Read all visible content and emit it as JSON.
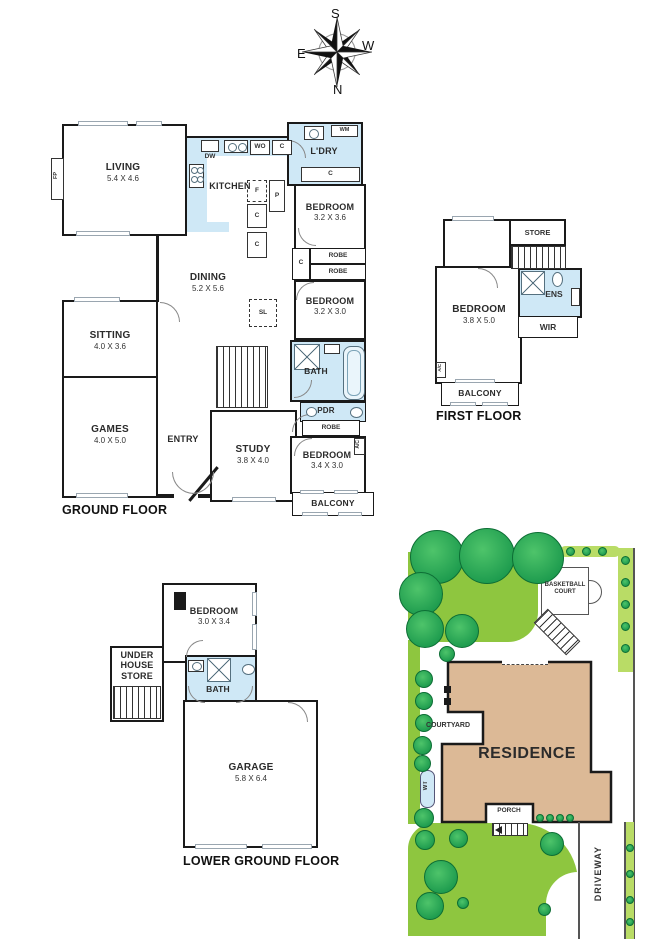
{
  "compass": {
    "top": "S",
    "right": "W",
    "left": "E",
    "bottom": "N"
  },
  "ground_floor": {
    "title": "GROUND FLOOR",
    "living": {
      "name": "LIVING",
      "dims": "5.4 X 4.6"
    },
    "kitchen": {
      "name": "KITCHEN"
    },
    "laundry": {
      "name": "L'DRY"
    },
    "dining": {
      "name": "DINING",
      "dims": "5.2 X 5.6"
    },
    "sitting": {
      "name": "SITTING",
      "dims": "4.0 X 3.6"
    },
    "games": {
      "name": "GAMES",
      "dims": "4.0 X 5.0"
    },
    "entry": {
      "name": "ENTRY"
    },
    "study": {
      "name": "STUDY",
      "dims": "3.8 X 4.0"
    },
    "bedroom1": {
      "name": "BEDROOM",
      "dims": "3.2 X 3.6"
    },
    "bedroom2": {
      "name": "BEDROOM",
      "dims": "3.2 X 3.0"
    },
    "bedroom3": {
      "name": "BEDROOM",
      "dims": "3.4 X 3.0"
    },
    "bath": {
      "name": "BATH"
    },
    "pdr": {
      "name": "PDR"
    },
    "balcony": {
      "name": "BALCONY"
    }
  },
  "first_floor": {
    "title": "FIRST FLOOR",
    "store": {
      "name": "STORE"
    },
    "bedroom": {
      "name": "BEDROOM",
      "dims": "3.8 X 5.0"
    },
    "ens": {
      "name": "ENS"
    },
    "wir": {
      "name": "WIR"
    },
    "balcony": {
      "name": "BALCONY"
    }
  },
  "lower_ground_floor": {
    "title": "LOWER GROUND FLOOR",
    "bedroom": {
      "name": "BEDROOM",
      "dims": "3.0 X 3.4"
    },
    "under_house_store": {
      "name": "UNDER HOUSE STORE"
    },
    "bath": {
      "name": "BATH"
    },
    "garage": {
      "name": "GARAGE",
      "dims": "5.8 X 6.4"
    }
  },
  "site_plan": {
    "residence": "RESIDENCE",
    "courtyard": "COURTYARD",
    "porch": "PORCH",
    "driveway": "DRIVEWAY",
    "basketball_court": "BASKETBALL COURT",
    "water_tank": "WT"
  },
  "fixtures": {
    "robe": "ROBE",
    "cupboard": "C",
    "fridge": "F",
    "pantry": "P",
    "wall_oven": "WO",
    "dishwasher": "DW",
    "washing_machine": "WM",
    "skylight": "SL",
    "air_con": "A/C",
    "fireplace": "FP"
  },
  "colors": {
    "wet_area": "#cfe8f6",
    "wall": "#1a1a1a",
    "lawn": "#8ec63f",
    "tree": "#1d9b4e",
    "residence_fill": "#dcb996",
    "hedge": "#b9dc66"
  }
}
